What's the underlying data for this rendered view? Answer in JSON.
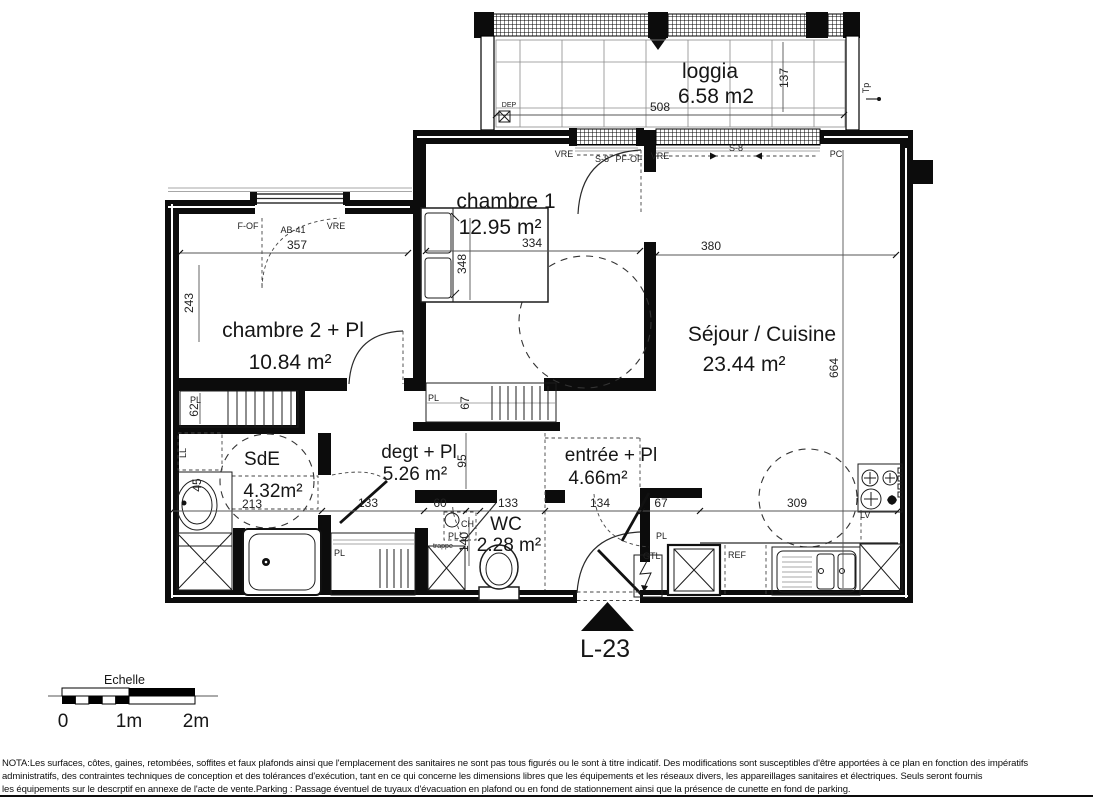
{
  "rooms": {
    "loggia": {
      "name": "loggia",
      "area": "6.58 m2"
    },
    "chambre1": {
      "name": "chambre 1",
      "area": "12.95 m²"
    },
    "chambre2": {
      "name": "chambre 2 + Pl",
      "area": "10.84 m²"
    },
    "sejour": {
      "name": "Séjour / Cuisine",
      "area": "23.44 m²"
    },
    "sde": {
      "name": "SdE",
      "area": "4.32m²"
    },
    "degt": {
      "name": "degt + Pl",
      "area": "5.26 m²"
    },
    "entree": {
      "name": "entrée + Pl",
      "area": "4.66m²"
    },
    "wc": {
      "name": "WC",
      "area": "2.28 m²"
    }
  },
  "dims": {
    "loggia_width": "508",
    "loggia_depth": "137",
    "chambre2_width": "357",
    "chambre2_depth": "243",
    "chambre1_width": "334",
    "chambre1_depth": "348",
    "sejour_width": "380",
    "sejour_depth": "664",
    "sde_width": "213",
    "sde_door": "133",
    "wc_niche": "60",
    "wc_width": "133",
    "wc_depth": "140",
    "entree_width": "134",
    "entree_pl_width": "67",
    "kitchen_width": "309",
    "hall_depth": "95",
    "pl1_depth": "62",
    "pl2_depth": "67",
    "basin_width": "45"
  },
  "tags": {
    "dep": "DEP",
    "tp": "Tp",
    "pc": "PC",
    "vre": "VRE",
    "s8": "S-8",
    "pfof": "PF-OF",
    "fof": "F-OF",
    "ab41": "AB-41",
    "ll": "LL",
    "pl": "PL",
    "ch": "CH",
    "trappe": "trappe",
    "gtl": "GTL",
    "ref": "REF",
    "lv": "LV"
  },
  "lot": {
    "label": "L-23"
  },
  "scalebar": {
    "title": "Echelle",
    "zero": "0",
    "one": "1m",
    "two": "2m"
  },
  "nota": {
    "l1": "NOTA:Les surfaces, côtes, gaines, retombées, soffites et faux plafonds ainsi que l'emplacement des sanitaires ne sont pas tous figurés ou le sont à titre indicatif. Des modifications sont susceptibles d'être apportées à ce plan en fonction des impératifs",
    "l2": "administratifs, des contraintes techniques de conception et des tolérances d'exécution, tant en ce qui concerne les dimensions libres que les équipements  et les réseaux divers, les appareillages sanitaires et électriques. Seuls seront fournis",
    "l3": "les équipements sur le descrptif en annexe de l'acte de vente.Parking : Passage éventuel de tuyaux d'évacuation en plafond ou en fond de stationnement ainsi que la présence de cunette en fond de parking."
  }
}
